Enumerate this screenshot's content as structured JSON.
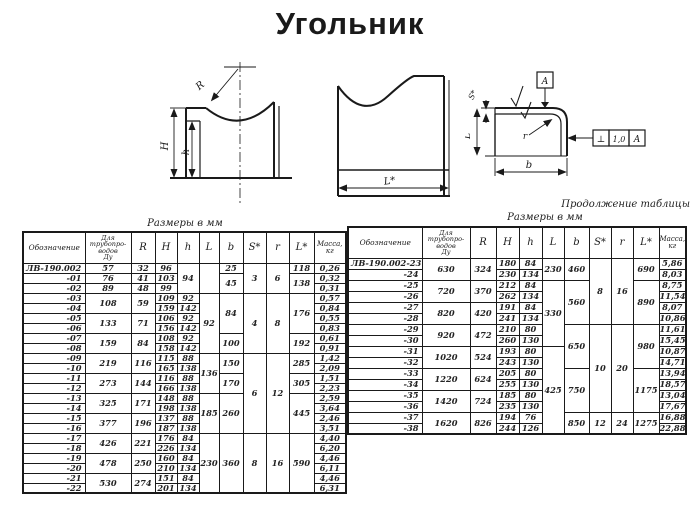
{
  "title": "Угольник",
  "captions": {
    "left_units": "Размеры в мм",
    "right_units": "Размеры в мм",
    "continuation": "Продолжение таблицы"
  },
  "drawings": {
    "front_view": {
      "radius_label": "R",
      "height_label": "H",
      "inner_height_label": "h"
    },
    "side_view": {
      "length_label": "L*"
    },
    "section_view": {
      "thickness_label": "S*",
      "leg_label": "L",
      "width_label": "b",
      "corner_radius_label": "r",
      "datum_label": "A",
      "tolerance_symbol": "⊥",
      "tolerance_value": "1,0",
      "tolerance_datum": "A"
    }
  },
  "tables": {
    "left": {
      "headers": [
        "Обозначение",
        "Для\nтрубопро-\nводов\nДу",
        "R",
        "H",
        "h",
        "L",
        "b",
        "S*",
        "r",
        "L*",
        "Масса,\nкг"
      ],
      "rows": [
        [
          {
            "v": "ЛВ-190.002"
          },
          {
            "v": "57"
          },
          {
            "v": "32"
          },
          {
            "v": "96"
          },
          {
            "v": "94",
            "rs": 3
          },
          {
            "v": "",
            "rs": 3
          },
          {
            "v": "25"
          },
          {
            "v": "3",
            "rs": 3
          },
          {
            "v": "6",
            "rs": 3
          },
          {
            "v": "118"
          },
          {
            "v": "0,26"
          }
        ],
        [
          {
            "v": "-01"
          },
          {
            "v": "76"
          },
          {
            "v": "41"
          },
          {
            "v": "103"
          },
          {
            "v": "45",
            "rs": 2
          },
          {
            "v": "138",
            "rs": 2
          },
          {
            "v": "0,32"
          }
        ],
        [
          {
            "v": "-02"
          },
          {
            "v": "89"
          },
          {
            "v": "48"
          },
          {
            "v": "99"
          },
          {
            "v": "0,31"
          }
        ],
        [
          {
            "v": "-03"
          },
          {
            "v": "108",
            "rs": 2
          },
          {
            "v": "59",
            "rs": 2
          },
          {
            "v": "109"
          },
          {
            "v": "92"
          },
          {
            "v": "92",
            "rs": 6
          },
          {
            "v": "84",
            "rs": 4
          },
          {
            "v": "4",
            "rs": 6
          },
          {
            "v": "8",
            "rs": 6
          },
          {
            "v": "176",
            "rs": 4
          },
          {
            "v": "0,57"
          }
        ],
        [
          {
            "v": "-04"
          },
          {
            "v": "159"
          },
          {
            "v": "142"
          },
          {
            "v": "0,84"
          }
        ],
        [
          {
            "v": "-05"
          },
          {
            "v": "133",
            "rs": 2
          },
          {
            "v": "71",
            "rs": 2
          },
          {
            "v": "106"
          },
          {
            "v": "92"
          },
          {
            "v": "0,55"
          }
        ],
        [
          {
            "v": "-06"
          },
          {
            "v": "156"
          },
          {
            "v": "142"
          },
          {
            "v": "0,83"
          }
        ],
        [
          {
            "v": "-07"
          },
          {
            "v": "159",
            "rs": 2
          },
          {
            "v": "84",
            "rs": 2
          },
          {
            "v": "108"
          },
          {
            "v": "92"
          },
          {
            "v": "100",
            "rs": 2
          },
          {
            "v": "192",
            "rs": 2
          },
          {
            "v": "0,61"
          }
        ],
        [
          {
            "v": "-08"
          },
          {
            "v": "158"
          },
          {
            "v": "142"
          },
          {
            "v": "0,91"
          }
        ],
        [
          {
            "v": "-09"
          },
          {
            "v": "219",
            "rs": 2
          },
          {
            "v": "116",
            "rs": 2
          },
          {
            "v": "115"
          },
          {
            "v": "88"
          },
          {
            "v": "136",
            "rs": 4
          },
          {
            "v": "150",
            "rs": 2
          },
          {
            "v": "6",
            "rs": 8
          },
          {
            "v": "12",
            "rs": 8
          },
          {
            "v": "285",
            "rs": 2
          },
          {
            "v": "1,42"
          }
        ],
        [
          {
            "v": "-10"
          },
          {
            "v": "165"
          },
          {
            "v": "138"
          },
          {
            "v": "2,09"
          }
        ],
        [
          {
            "v": "-11"
          },
          {
            "v": "273",
            "rs": 2
          },
          {
            "v": "144",
            "rs": 2
          },
          {
            "v": "116"
          },
          {
            "v": "88"
          },
          {
            "v": "170",
            "rs": 2
          },
          {
            "v": "305",
            "rs": 2
          },
          {
            "v": "1,51"
          }
        ],
        [
          {
            "v": "-12"
          },
          {
            "v": "166"
          },
          {
            "v": "138"
          },
          {
            "v": "2,23"
          }
        ],
        [
          {
            "v": "-13"
          },
          {
            "v": "325",
            "rs": 2
          },
          {
            "v": "171",
            "rs": 2
          },
          {
            "v": "148"
          },
          {
            "v": "88"
          },
          {
            "v": "185",
            "rs": 4
          },
          {
            "v": "260",
            "rs": 4
          },
          {
            "v": "445",
            "rs": 4
          },
          {
            "v": "2,59"
          }
        ],
        [
          {
            "v": "-14"
          },
          {
            "v": "198"
          },
          {
            "v": "138"
          },
          {
            "v": "3,64"
          }
        ],
        [
          {
            "v": "-15"
          },
          {
            "v": "377",
            "rs": 2
          },
          {
            "v": "196",
            "rs": 2
          },
          {
            "v": "137"
          },
          {
            "v": "88"
          },
          {
            "v": "2,46"
          }
        ],
        [
          {
            "v": "-16"
          },
          {
            "v": "187"
          },
          {
            "v": "138"
          },
          {
            "v": "3,51"
          }
        ],
        [
          {
            "v": "-17"
          },
          {
            "v": "426",
            "rs": 2
          },
          {
            "v": "221",
            "rs": 2
          },
          {
            "v": "176"
          },
          {
            "v": "84"
          },
          {
            "v": "230",
            "rs": 6
          },
          {
            "v": "360",
            "rs": 6
          },
          {
            "v": "8",
            "rs": 6
          },
          {
            "v": "16",
            "rs": 6
          },
          {
            "v": "590",
            "rs": 6
          },
          {
            "v": "4,40"
          }
        ],
        [
          {
            "v": "-18"
          },
          {
            "v": "226"
          },
          {
            "v": "134"
          },
          {
            "v": "6,20"
          }
        ],
        [
          {
            "v": "-19"
          },
          {
            "v": "478",
            "rs": 2
          },
          {
            "v": "250",
            "rs": 2
          },
          {
            "v": "160"
          },
          {
            "v": "84"
          },
          {
            "v": "4,46"
          }
        ],
        [
          {
            "v": "-20"
          },
          {
            "v": "210"
          },
          {
            "v": "134"
          },
          {
            "v": "6,11"
          }
        ],
        [
          {
            "v": "-21"
          },
          {
            "v": "530",
            "rs": 2
          },
          {
            "v": "274",
            "rs": 2
          },
          {
            "v": "151"
          },
          {
            "v": "84"
          },
          {
            "v": "4,46"
          }
        ],
        [
          {
            "v": "-22"
          },
          {
            "v": "201"
          },
          {
            "v": "134"
          },
          {
            "v": "6,31"
          }
        ]
      ]
    },
    "right": {
      "headers": [
        "Обозначение",
        "Для\nтрубопро-\nводов\nДу",
        "R",
        "H",
        "h",
        "L",
        "b",
        "S*",
        "r",
        "L*",
        "Масса,\nкг"
      ],
      "rows": [
        [
          {
            "v": "ЛВ-190.002-23"
          },
          {
            "v": "630",
            "rs": 2
          },
          {
            "v": "324",
            "rs": 2
          },
          {
            "v": "180"
          },
          {
            "v": "84"
          },
          {
            "v": "230",
            "rs": 2
          },
          {
            "v": "460",
            "rs": 2
          },
          {
            "v": "8",
            "rs": 6
          },
          {
            "v": "16",
            "rs": 6
          },
          {
            "v": "690",
            "rs": 2
          },
          {
            "v": "5,86"
          }
        ],
        [
          {
            "v": "-24"
          },
          {
            "v": "230"
          },
          {
            "v": "134"
          },
          {
            "v": "8,03"
          }
        ],
        [
          {
            "v": "-25"
          },
          {
            "v": "720",
            "rs": 2
          },
          {
            "v": "370",
            "rs": 2
          },
          {
            "v": "212"
          },
          {
            "v": "84"
          },
          {
            "v": "330",
            "rs": 6
          },
          {
            "v": "560",
            "rs": 4
          },
          {
            "v": "890",
            "rs": 4
          },
          {
            "v": "8,75"
          }
        ],
        [
          {
            "v": "-26"
          },
          {
            "v": "262"
          },
          {
            "v": "134"
          },
          {
            "v": "11,54"
          }
        ],
        [
          {
            "v": "-27"
          },
          {
            "v": "820",
            "rs": 2
          },
          {
            "v": "420",
            "rs": 2
          },
          {
            "v": "191"
          },
          {
            "v": "84"
          },
          {
            "v": "8,07"
          }
        ],
        [
          {
            "v": "-28"
          },
          {
            "v": "241"
          },
          {
            "v": "134"
          },
          {
            "v": "10,86"
          }
        ],
        [
          {
            "v": "-29"
          },
          {
            "v": "920",
            "rs": 2
          },
          {
            "v": "472",
            "rs": 2
          },
          {
            "v": "210"
          },
          {
            "v": "80"
          },
          {
            "v": "650",
            "rs": 4
          },
          {
            "v": "10",
            "rs": 8
          },
          {
            "v": "20",
            "rs": 8
          },
          {
            "v": "980",
            "rs": 4
          },
          {
            "v": "11,61"
          }
        ],
        [
          {
            "v": "-30"
          },
          {
            "v": "260"
          },
          {
            "v": "130"
          },
          {
            "v": "15,45"
          }
        ],
        [
          {
            "v": "-31"
          },
          {
            "v": "1020",
            "rs": 2
          },
          {
            "v": "524",
            "rs": 2
          },
          {
            "v": "193"
          },
          {
            "v": "80"
          },
          {
            "v": "425",
            "rs": 8
          },
          {
            "v": "10,87"
          }
        ],
        [
          {
            "v": "-32"
          },
          {
            "v": "243"
          },
          {
            "v": "130"
          },
          {
            "v": "14,71"
          }
        ],
        [
          {
            "v": "-33"
          },
          {
            "v": "1220",
            "rs": 2
          },
          {
            "v": "624",
            "rs": 2
          },
          {
            "v": "205"
          },
          {
            "v": "80"
          },
          {
            "v": "750",
            "rs": 4
          },
          {
            "v": "1175",
            "rs": 4
          },
          {
            "v": "13,94"
          }
        ],
        [
          {
            "v": "-34"
          },
          {
            "v": "255"
          },
          {
            "v": "130"
          },
          {
            "v": "18,57"
          }
        ],
        [
          {
            "v": "-35"
          },
          {
            "v": "1420",
            "rs": 2
          },
          {
            "v": "724",
            "rs": 2
          },
          {
            "v": "185"
          },
          {
            "v": "80"
          },
          {
            "v": "13,04"
          }
        ],
        [
          {
            "v": "-36"
          },
          {
            "v": "235"
          },
          {
            "v": "130"
          },
          {
            "v": "17,67"
          }
        ],
        [
          {
            "v": "-37"
          },
          {
            "v": "1620",
            "rs": 2
          },
          {
            "v": "826",
            "rs": 2
          },
          {
            "v": "194"
          },
          {
            "v": "76"
          },
          {
            "v": "850",
            "rs": 2
          },
          {
            "v": "12",
            "rs": 2
          },
          {
            "v": "24",
            "rs": 2
          },
          {
            "v": "1275",
            "rs": 2
          },
          {
            "v": "16,88"
          }
        ],
        [
          {
            "v": "-38"
          },
          {
            "v": "244"
          },
          {
            "v": "126"
          },
          {
            "v": "22,88"
          }
        ]
      ]
    }
  }
}
